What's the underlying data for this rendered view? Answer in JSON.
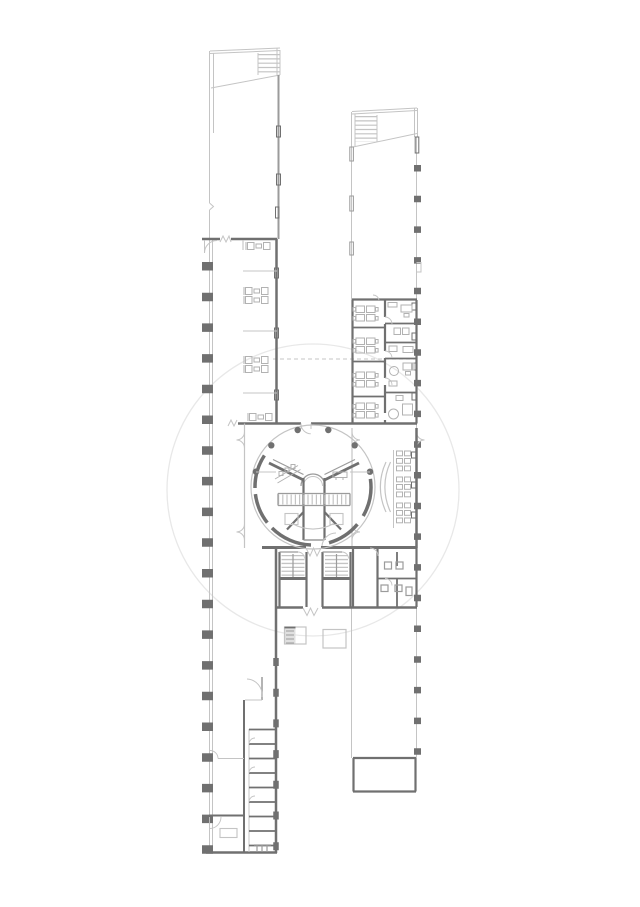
{
  "meta": {
    "title": "Architectural floor plan",
    "description": "Line drawing of one building level: two long narrow wings joined by a central block containing a circular rotunda with twin escalator banks, stair cores, restrooms and furnished office rooms.",
    "canvas": {
      "width": 640,
      "height": 907
    }
  },
  "palette": {
    "background": "#ffffff",
    "wall_dark": "#707070",
    "wall_medium": "#9b9b9b",
    "line_light": "#c4c4c4",
    "line_faint": "#e8e8e8",
    "furniture": "#b2b2b2",
    "fill_shaded": "#e0e0e0"
  },
  "components": {
    "site_circle": "faint circular site boundary",
    "left_wing": "left wing",
    "left_wing_canopy": "left wing canopy with ladder hatch",
    "left_wing_rooms": "left wing rooms and desk rows",
    "room_stack": "stack of small rooms, lower left wing",
    "right_wing": "right wing",
    "right_wing_canopy": "right wing canopy with ladder hatch",
    "offices": "office rooms with desks",
    "end_room": "room at end of right wing",
    "central_hall": "central hall",
    "rotunda": "rotunda with dome and escalators",
    "columns": "structural columns",
    "escalators": "escalator bands",
    "dome": "central dome",
    "annex_seating": "seating rows beside rotunda",
    "stair_block": "stair cores and restrooms",
    "tables": "freestanding tables",
    "entrance_doors": "double swing doors",
    "dashed_axis": "dashed reference line"
  }
}
